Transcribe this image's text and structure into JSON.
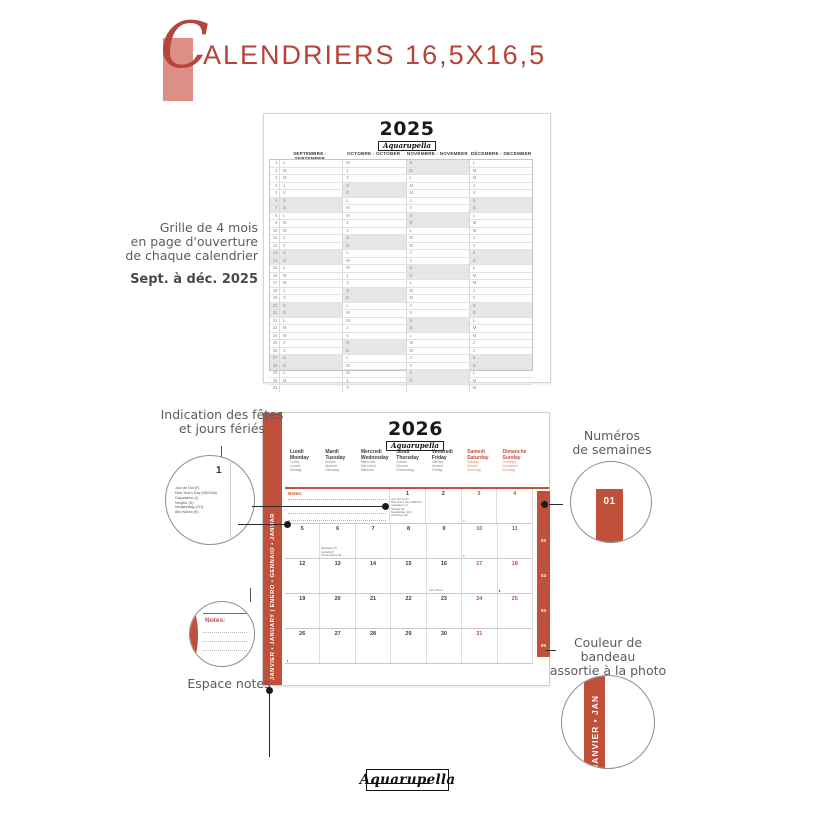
{
  "header": {
    "title_initial": "C",
    "title_rest": "ALENDRIERS 16,5X16,5",
    "accent_color": "#b5443b",
    "pink_color": "#dd8e85"
  },
  "annotations": {
    "grille": {
      "lines": [
        "Grille de 4 mois",
        "en page d'ouverture",
        "de chaque calendrier"
      ],
      "sub": "Sept. à déc. 2025"
    },
    "holidays": {
      "lines": [
        "Indication des fêtes",
        "et jours fériés"
      ]
    },
    "weeks": {
      "lines": [
        "Numéros",
        "de semaines"
      ],
      "badge": "01"
    },
    "notes": {
      "label": "Espace notes",
      "zoom_label": "Notes:"
    },
    "band": {
      "lines": [
        "Couleur de bandeau",
        "assortie à la photo",
        "du mois"
      ],
      "zoom_text": "JANVIER • JAN"
    }
  },
  "calendar2025": {
    "year": "2025",
    "logo": "Aquarupella",
    "months": [
      {
        "header": "SEPTEMBRE - SEPTEMBER",
        "letters": [
          "L",
          "M",
          "M",
          "J",
          "V",
          "S",
          "D",
          "L",
          "M",
          "M",
          "J",
          "V",
          "S",
          "D",
          "L",
          "M",
          "M",
          "J",
          "V",
          "S",
          "D",
          "L",
          "M",
          "M",
          "J",
          "V",
          "S",
          "D",
          "L",
          "M",
          ""
        ],
        "weekend": [
          6,
          7,
          13,
          14,
          20,
          21,
          27,
          28
        ]
      },
      {
        "header": "OCTOBRE - OCTOBER",
        "letters": [
          "M",
          "J",
          "V",
          "S",
          "D",
          "L",
          "M",
          "M",
          "J",
          "V",
          "S",
          "D",
          "L",
          "M",
          "M",
          "J",
          "V",
          "S",
          "D",
          "L",
          "M",
          "M",
          "J",
          "V",
          "S",
          "D",
          "L",
          "M",
          "M",
          "J",
          "V"
        ],
        "weekend": [
          4,
          5,
          11,
          12,
          18,
          19,
          25,
          26
        ]
      },
      {
        "header": "NOVEMBRE - NOVEMBER",
        "letters": [
          "S",
          "D",
          "L",
          "M",
          "M",
          "J",
          "V",
          "S",
          "D",
          "L",
          "M",
          "M",
          "J",
          "V",
          "S",
          "D",
          "L",
          "M",
          "M",
          "J",
          "V",
          "S",
          "D",
          "L",
          "M",
          "M",
          "J",
          "V",
          "S",
          "D",
          ""
        ],
        "weekend": [
          1,
          2,
          8,
          9,
          15,
          16,
          22,
          23,
          29,
          30
        ]
      },
      {
        "header": "DÉCEMBRE - DECEMBER",
        "letters": [
          "L",
          "M",
          "M",
          "J",
          "V",
          "S",
          "D",
          "L",
          "M",
          "M",
          "J",
          "V",
          "S",
          "D",
          "L",
          "M",
          "M",
          "J",
          "V",
          "S",
          "D",
          "L",
          "M",
          "M",
          "J",
          "V",
          "S",
          "D",
          "L",
          "M",
          "M"
        ],
        "weekend": [
          6,
          7,
          13,
          14,
          20,
          21,
          27,
          28
        ]
      }
    ]
  },
  "calendar2026": {
    "year": "2026",
    "logo": "Aquarupella",
    "side_label": "JANVIER • JANUARY | ENERO • GENNAIO • JANUAR",
    "band_color": "#c0503a",
    "notes_label": "Notes:",
    "day_headers": [
      {
        "main": [
          "Lundi",
          "Monday"
        ],
        "small": [
          "Lunes",
          "Lunedì",
          "Montag"
        ],
        "weekend": false
      },
      {
        "main": [
          "Mardi",
          "Tuesday"
        ],
        "small": [
          "Martes",
          "Martedì",
          "Dienstag"
        ],
        "weekend": false
      },
      {
        "main": [
          "Mercredi",
          "Wednesday"
        ],
        "small": [
          "Miércoles",
          "Mercoledì",
          "Mittwoch"
        ],
        "weekend": false
      },
      {
        "main": [
          "Jeudi",
          "Thursday"
        ],
        "small": [
          "Jueves",
          "Giovedì",
          "Donnerstag"
        ],
        "weekend": false
      },
      {
        "main": [
          "Vendredi",
          "Friday"
        ],
        "small": [
          "Viernes",
          "Venerdì",
          "Freitag"
        ],
        "weekend": false
      },
      {
        "main": [
          "Samedi",
          "Saturday"
        ],
        "small": [
          "Sábado",
          "Sabato",
          "Samstag"
        ],
        "weekend": true
      },
      {
        "main": [
          "Dimanche",
          "Sunday"
        ],
        "small": [
          "Domingo",
          "Domenica",
          "Sonntag"
        ],
        "weekend": true
      }
    ],
    "weeks": [
      {
        "num": "01",
        "cells": [
          {
            "notes": true
          },
          {
            "notes": true
          },
          {
            "notes": true
          },
          {
            "day": "1",
            "holidays": [
              "Jour de l'An (F)",
              "New Year's Day (GB/USA)",
              "Capodanno (I)",
              "Neujahr (D)",
              "Neujahrstag (CH)",
              "Año Nuevo (E)"
            ]
          },
          {
            "day": "2"
          },
          {
            "day": "3",
            "weekend": true,
            "moon": "○"
          },
          {
            "day": "4",
            "weekend": true
          }
        ]
      },
      {
        "num": "02",
        "cells": [
          {
            "day": "5"
          },
          {
            "day": "6",
            "holidays": [
              "Épiphanie (F)",
              "Epifania (I)",
              "Día de Reyes (E)"
            ],
            "holidays_bottom": true
          },
          {
            "day": "7"
          },
          {
            "day": "8"
          },
          {
            "day": "9"
          },
          {
            "day": "10",
            "weekend": true,
            "moon": "◐"
          },
          {
            "day": "11",
            "weekend": true
          }
        ]
      },
      {
        "num": "03",
        "cells": [
          {
            "day": "12"
          },
          {
            "day": "13"
          },
          {
            "day": "14"
          },
          {
            "day": "15"
          },
          {
            "day": "16",
            "note": "Lune d'hiver"
          },
          {
            "day": "17",
            "weekend": true
          },
          {
            "day": "18",
            "weekend": true,
            "moon": "●"
          }
        ]
      },
      {
        "num": "04",
        "cells": [
          {
            "day": "19"
          },
          {
            "day": "20"
          },
          {
            "day": "21"
          },
          {
            "day": "22"
          },
          {
            "day": "23"
          },
          {
            "day": "24",
            "weekend": true
          },
          {
            "day": "25",
            "weekend": true
          }
        ]
      },
      {
        "num": "05",
        "cells": [
          {
            "day": "26",
            "moon": "◑"
          },
          {
            "day": "27"
          },
          {
            "day": "28"
          },
          {
            "day": "29"
          },
          {
            "day": "30"
          },
          {
            "day": "31",
            "weekend": true
          },
          {
            "day": ""
          }
        ]
      }
    ]
  },
  "footer": {
    "logo": "Aquarupella"
  }
}
